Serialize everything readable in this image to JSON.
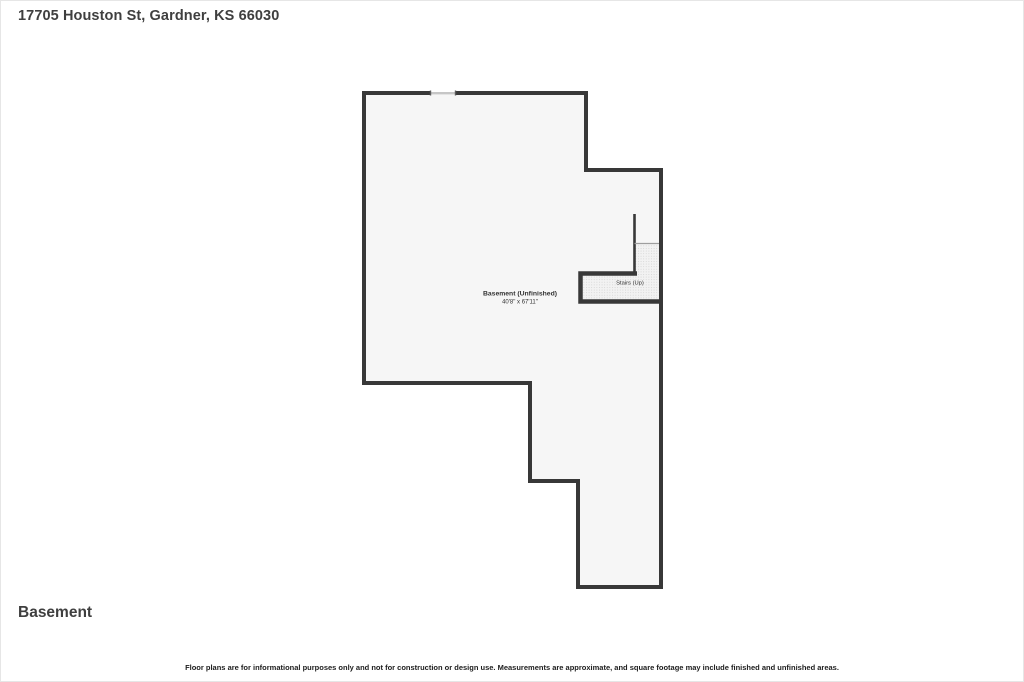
{
  "page": {
    "title": "17705 Houston St, Gardner, KS 66030",
    "floor_label": "Basement",
    "disclaimer": "Floor plans are for informational purposes only and not for construction or design use. Measurements are approximate, and square footage may include finished and unfinished areas."
  },
  "floor_plan": {
    "room_label": "Basement (Unfinished)",
    "room_dimensions": "40'8\" x 67'11\"",
    "stairs_label": "Stairs (Up)",
    "colors": {
      "wall": "#383838",
      "floor_fill": "#f6f6f6",
      "window": "#c6c6c6",
      "stair_break_line": "#9e9e9e",
      "stair_dot": "#d4d4d4",
      "title_text": "#3f3f3f",
      "label_text": "#333333"
    }
  }
}
